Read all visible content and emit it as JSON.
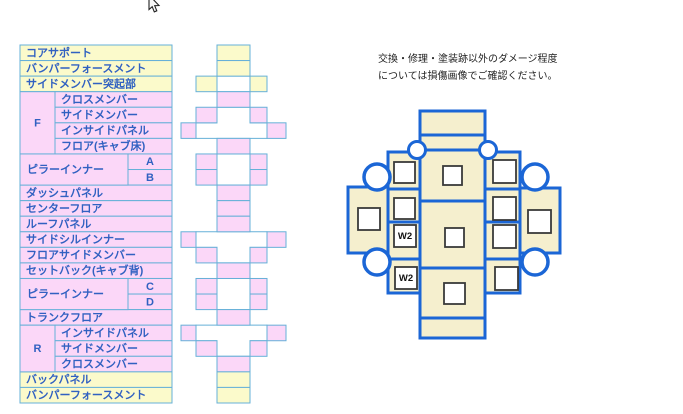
{
  "note": {
    "line1": "交換・修理・塗装跡以外のダメージ程度",
    "line2": "については損傷画像でご確認ください。"
  },
  "colors": {
    "pink": "#fbd7f8",
    "yellow": "#fbfacb",
    "white": "#ffffff",
    "cell_border": "#66b0d8",
    "table_text": "#3161c1",
    "diagram_blue": "#1b66d6",
    "cream": "#f5efce",
    "square_border": "#3a3a3a",
    "w2_text": "#111111"
  },
  "table": {
    "rows": [
      {
        "label": "コアサポート",
        "bg": "yellow"
      },
      {
        "label": "バンパーフォースメント",
        "bg": "yellow"
      },
      {
        "label": "サイドメンバー突起部",
        "bg": "yellow"
      },
      {
        "label": "クロスメンバー",
        "bg": "pink",
        "indent": "group"
      },
      {
        "label": "サイドメンバー",
        "bg": "pink",
        "indent": "group"
      },
      {
        "label": "インサイドパネル",
        "bg": "pink",
        "indent": "group"
      },
      {
        "label": "フロア(キャブ床)",
        "bg": "pink",
        "indent": "group"
      },
      {
        "label": "A",
        "bg": "pink",
        "indent": "pillar"
      },
      {
        "label": "B",
        "bg": "pink",
        "indent": "pillar"
      },
      {
        "label": "ダッシュパネル",
        "bg": "pink"
      },
      {
        "label": "センターフロア",
        "bg": "pink"
      },
      {
        "label": "ルーフパネル",
        "bg": "pink"
      },
      {
        "label": "サイドシルインナー",
        "bg": "pink"
      },
      {
        "label": "フロアサイドメンバー",
        "bg": "pink"
      },
      {
        "label": "セットバック(キャブ背)",
        "bg": "pink"
      },
      {
        "label": "C",
        "bg": "pink",
        "indent": "pillar"
      },
      {
        "label": "D",
        "bg": "pink",
        "indent": "pillar"
      },
      {
        "label": "トランクフロア",
        "bg": "pink"
      },
      {
        "label": "インサイドパネル",
        "bg": "pink",
        "indent": "group"
      },
      {
        "label": "サイドメンバー",
        "bg": "pink",
        "indent": "group"
      },
      {
        "label": "クロスメンバー",
        "bg": "pink",
        "indent": "group"
      },
      {
        "label": "バックパネル",
        "bg": "yellow"
      },
      {
        "label": "バンパーフォースメント",
        "bg": "yellow"
      }
    ],
    "groups": [
      {
        "label": "F",
        "start": 4,
        "span": 4,
        "type": "letter"
      },
      {
        "label": "ピラーインナー",
        "start": 8,
        "span": 2,
        "type": "pillar"
      },
      {
        "label": "ピラーインナー",
        "start": 16,
        "span": 2,
        "type": "pillar"
      },
      {
        "label": "R",
        "start": 19,
        "span": 3,
        "type": "letter"
      }
    ]
  },
  "frame_diagram": {
    "rows": [
      [
        [
          "C",
          "yellow"
        ]
      ],
      [
        [
          "C",
          "yellow"
        ]
      ],
      [
        [
          "NL",
          "yellow"
        ],
        [
          "NR",
          "yellow"
        ]
      ],
      [
        [
          "C",
          "pink"
        ]
      ],
      [
        [
          "NL",
          "pink"
        ],
        [
          "NR",
          "pink"
        ]
      ],
      [
        [
          "FL",
          "pink"
        ],
        [
          "FR",
          "pink"
        ]
      ],
      [
        [
          "C",
          "pink"
        ]
      ],
      [
        [
          "NL",
          "pink"
        ],
        [
          "NR",
          "pink"
        ]
      ],
      [
        [
          "NL",
          "pink"
        ],
        [
          "NR",
          "pink"
        ]
      ],
      [
        [
          "C",
          "pink"
        ]
      ],
      [
        [
          "C",
          "pink"
        ]
      ],
      [
        [
          "C",
          "pink"
        ]
      ],
      [
        [
          "FL",
          "pink"
        ],
        [
          "FR",
          "pink"
        ]
      ],
      [
        [
          "NL",
          "pink"
        ],
        [
          "NR",
          "pink"
        ]
      ],
      [
        [
          "C",
          "pink"
        ]
      ],
      [
        [
          "NL",
          "pink"
        ],
        [
          "NR",
          "pink"
        ]
      ],
      [
        [
          "NL",
          "pink"
        ],
        [
          "NR",
          "pink"
        ]
      ],
      [
        [
          "C",
          "pink"
        ]
      ],
      [
        [
          "FL",
          "pink"
        ],
        [
          "FR",
          "pink"
        ]
      ],
      [
        [
          "NL",
          "pink"
        ],
        [
          "NR",
          "pink"
        ]
      ],
      [
        [
          "C",
          "pink"
        ]
      ],
      [
        [
          "C",
          "yellow"
        ]
      ],
      [
        [
          "C",
          "yellow"
        ]
      ]
    ],
    "whites": [
      {
        "type": "rect",
        "rows": [
          3,
          3
        ]
      },
      {
        "type": "T_down",
        "rows": [
          5,
          6
        ]
      },
      {
        "type": "rect",
        "rows": [
          8,
          9
        ]
      },
      {
        "type": "T_up",
        "rows": [
          13,
          14
        ]
      },
      {
        "type": "rect",
        "rows": [
          16,
          17
        ]
      },
      {
        "type": "T_up",
        "rows": [
          19,
          20
        ]
      }
    ]
  },
  "vehicle_diagram": {
    "w2_labels": [
      "W2",
      "W2"
    ]
  }
}
